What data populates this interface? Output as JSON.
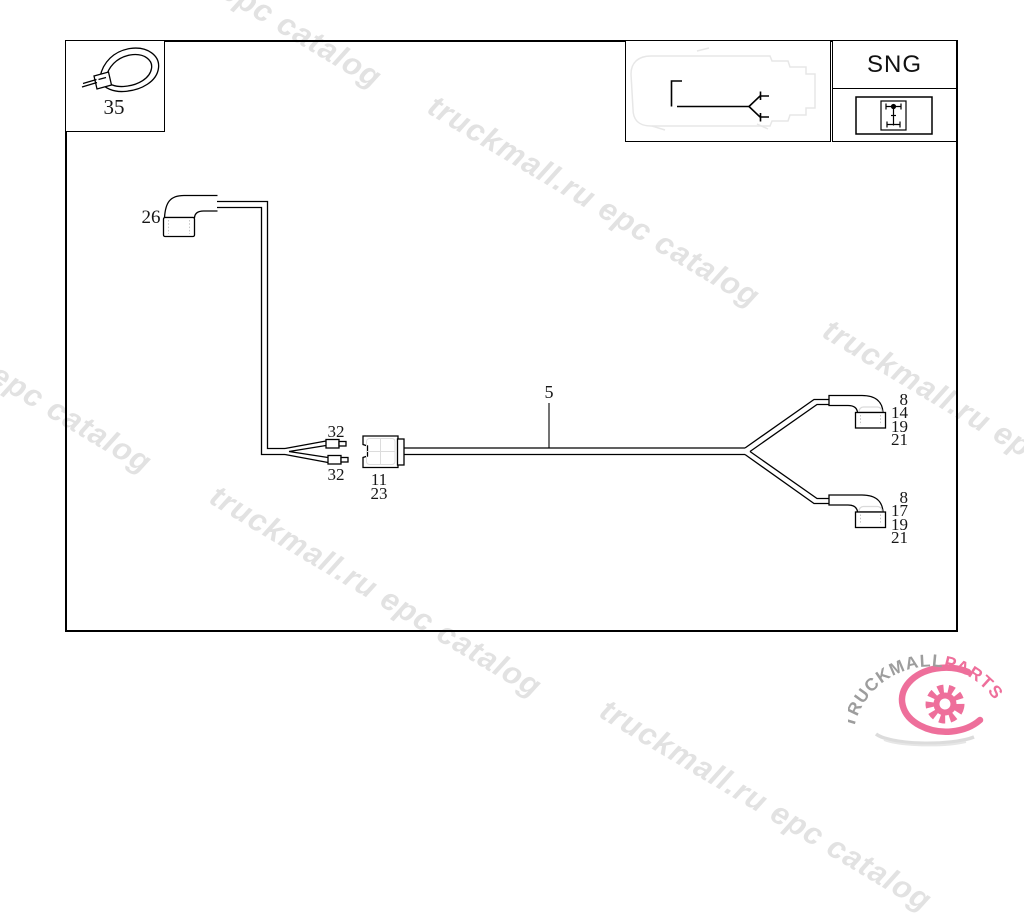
{
  "watermark": {
    "text": "truckmall.ru epc catalog"
  },
  "legend": {
    "code": "SNG"
  },
  "parts": {
    "cable_tie": "35",
    "elbow": "26",
    "harness": "5",
    "terminal_upper": "32",
    "terminal_lower": "32",
    "connector_row1": "11",
    "connector_row2": "23",
    "branch_top": [
      "8",
      "14",
      "19",
      "21"
    ],
    "branch_bottom": [
      "8",
      "17",
      "19",
      "21"
    ]
  },
  "logo": {
    "name_gray": "TRUCKMALL",
    "name_pink": "PARTS"
  },
  "colors": {
    "line": "#000000",
    "watermark": "#e2e2e2",
    "logo_gray": "#9d9d9d",
    "logo_pink": "#ee6f9b"
  }
}
